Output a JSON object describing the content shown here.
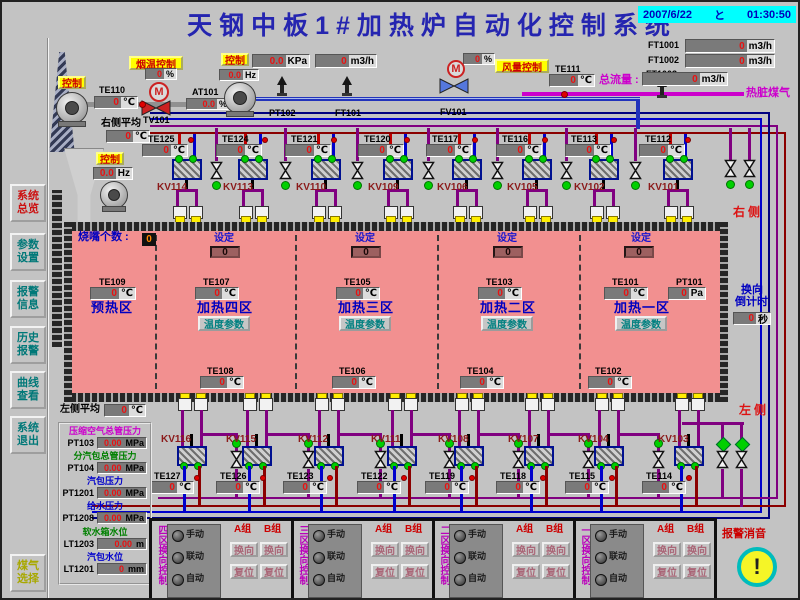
{
  "title": "天钢中板1#加热炉自动化控制系统",
  "datetime": {
    "date": "2007/6/22",
    "clock": "と",
    "time": "01:30:50"
  },
  "sidebar": {
    "items": [
      {
        "label": "系统总览",
        "color": "#cc1111"
      },
      {
        "label": "参数设置",
        "color": "#007878"
      },
      {
        "label": "报警信息",
        "color": "#007878"
      },
      {
        "label": "历史报警",
        "color": "#007878"
      },
      {
        "label": "曲线查看",
        "color": "#007878"
      },
      {
        "label": "系统退出",
        "color": "#007878"
      },
      {
        "label": "煤气选择",
        "color": "#a8a800"
      }
    ]
  },
  "top_left": {
    "control1": "控制",
    "control2": "控制",
    "smoke_btn": "烟温控制",
    "te110": {
      "label": "TE110",
      "value": "0",
      "unit": "℃"
    },
    "tv101_pct": {
      "value": "0",
      "unit": "%"
    },
    "tv101": "TV101",
    "at101": {
      "label": "AT101",
      "value": "0.0",
      "unit": "%"
    },
    "right_avg": {
      "label": "右侧平均",
      "value": "0",
      "unit": "℃"
    },
    "hz": {
      "value": "0.0",
      "unit": "Hz"
    }
  },
  "top_mid": {
    "control": "控制",
    "kpa": {
      "value": "0.0",
      "unit": "KPa"
    },
    "flow": {
      "value": "0",
      "unit": "m3/h"
    },
    "hz": {
      "value": "0.0",
      "unit": "Hz"
    },
    "pt102": "PT102",
    "ft101": "FT101",
    "fv101": "FV101",
    "fv101_pct": {
      "value": "0",
      "unit": "%"
    },
    "air_btn": "风量控制"
  },
  "top_right": {
    "ft1001": {
      "label": "FT1001",
      "value": "0",
      "unit": "m3/h"
    },
    "ft1002": {
      "label": "FT1002",
      "value": "0",
      "unit": "m3/h"
    },
    "ft1003": "FT1003",
    "te111": {
      "label": "TE111",
      "value": "0",
      "unit": "℃"
    },
    "total": {
      "label": "总流量 :",
      "value": "0",
      "unit": "m3/h"
    },
    "gas": "热脏煤气"
  },
  "upper_row": {
    "te": [
      {
        "label": "TE125",
        "value": "0",
        "unit": "℃"
      },
      {
        "label": "TE124",
        "value": "0",
        "unit": "℃"
      },
      {
        "label": "TE121",
        "value": "0",
        "unit": "℃"
      },
      {
        "label": "TE120",
        "value": "0",
        "unit": "℃"
      },
      {
        "label": "TE117",
        "value": "0",
        "unit": "℃"
      },
      {
        "label": "TE116",
        "value": "0",
        "unit": "℃"
      },
      {
        "label": "TE113",
        "value": "0",
        "unit": "℃"
      },
      {
        "label": "TE112",
        "value": "0",
        "unit": "℃"
      }
    ],
    "kv": [
      "KV114",
      "KV113",
      "KV110",
      "KV109",
      "KV106",
      "KV105",
      "KV102",
      "KV101"
    ]
  },
  "lower_row": {
    "te": [
      {
        "label": "TE127",
        "value": "0",
        "unit": "℃"
      },
      {
        "label": "TE126",
        "value": "0",
        "unit": "℃"
      },
      {
        "label": "TE123",
        "value": "0",
        "unit": "℃"
      },
      {
        "label": "TE122",
        "value": "0",
        "unit": "℃"
      },
      {
        "label": "TE119",
        "value": "0",
        "unit": "℃"
      },
      {
        "label": "TE118",
        "value": "0",
        "unit": "℃"
      },
      {
        "label": "TE115",
        "value": "0",
        "unit": "℃"
      },
      {
        "label": "TE114",
        "value": "0",
        "unit": "℃"
      }
    ],
    "kv": [
      "KV116",
      "KV115",
      "KV112",
      "KV111",
      "KV108",
      "KV107",
      "KV104",
      "KV103"
    ]
  },
  "furnace": {
    "burner_count": {
      "label": "烧嘴个数 :",
      "value": "0"
    },
    "zones": [
      {
        "name": "预热区",
        "te": {
          "label": "TE109",
          "value": "0",
          "unit": "℃"
        }
      },
      {
        "name": "加热四区",
        "set_label": "设定",
        "set_value": "0",
        "te": {
          "label": "TE107",
          "value": "0",
          "unit": "℃"
        },
        "param_button": "温度参数"
      },
      {
        "name": "加热三区",
        "set_label": "设定",
        "set_value": "0",
        "te": {
          "label": "TE105",
          "value": "0",
          "unit": "℃"
        },
        "param_button": "温度参数"
      },
      {
        "name": "加热二区",
        "set_label": "设定",
        "set_value": "0",
        "te": {
          "label": "TE103",
          "value": "0",
          "unit": "℃"
        },
        "param_button": "温度参数"
      },
      {
        "name": "加热一区",
        "set_label": "设定",
        "set_value": "0",
        "te": {
          "label": "TE101",
          "value": "0",
          "unit": "℃"
        },
        "pt": {
          "label": "PT101",
          "value": "0",
          "unit": "Pa"
        },
        "param_button": "温度参数"
      }
    ],
    "bottom_te": [
      {
        "label": "TE108",
        "value": "0",
        "unit": "℃"
      },
      {
        "label": "TE106",
        "value": "0",
        "unit": "℃"
      },
      {
        "label": "TE104",
        "value": "0",
        "unit": "℃"
      },
      {
        "label": "TE102",
        "value": "0",
        "unit": "℃"
      }
    ]
  },
  "countdown": {
    "l1": "换向",
    "l2": "倒计时",
    "value": "0",
    "unit": "秒"
  },
  "side_labels": {
    "right": "右侧",
    "left": "左侧"
  },
  "left_panel": {
    "avg": {
      "label": "左侧平均",
      "value": "0",
      "unit": "℃"
    },
    "items": [
      {
        "name": "压缩空气总管压力",
        "color": "#cc00cc",
        "tag": "PT103",
        "value": "0.00",
        "unit": "MPa"
      },
      {
        "name": "分汽包总管压力",
        "color": "#008000",
        "tag": "PT104",
        "value": "0.00",
        "unit": "MPa"
      },
      {
        "name": "汽包压力",
        "color": "#0000cc",
        "tag": "PT1201",
        "value": "0.00",
        "unit": "MPa"
      },
      {
        "name": "给水压力",
        "color": "#0000cc",
        "tag": "PT1208",
        "value": "0.00",
        "unit": "MPa"
      },
      {
        "name": "软水箱水位",
        "color": "#008000",
        "tag": "LT1203",
        "value": "0.00",
        "unit": "m"
      },
      {
        "name": "汽包水位",
        "color": "#0000cc",
        "tag": "LT1201",
        "value": "0",
        "unit": "mm"
      }
    ]
  },
  "reversing": {
    "titles": [
      "四区换向控制",
      "三区换向控制",
      "二区换向控制",
      "一区换向控制"
    ],
    "lamps": [
      "手动",
      "联动",
      "自动"
    ],
    "group_a": "A组",
    "group_b": "B组",
    "reverse_button": "换向",
    "reset_button": "复位"
  },
  "alarm": {
    "label": "报警消音",
    "icon": "!"
  },
  "colors": {
    "furnace_pink": "#f29090",
    "accent_cyan": "#00ffff",
    "button_yellow": "#ffff00",
    "zone_blue": "#0000c0",
    "kv_red": "#8b1a1a",
    "indicator_green": "#00d000",
    "pipe_purple": "#800080",
    "pipe_blue": "#0000cc",
    "pipe_navy": "#000080",
    "pipe_maroon": "#8b0000"
  }
}
